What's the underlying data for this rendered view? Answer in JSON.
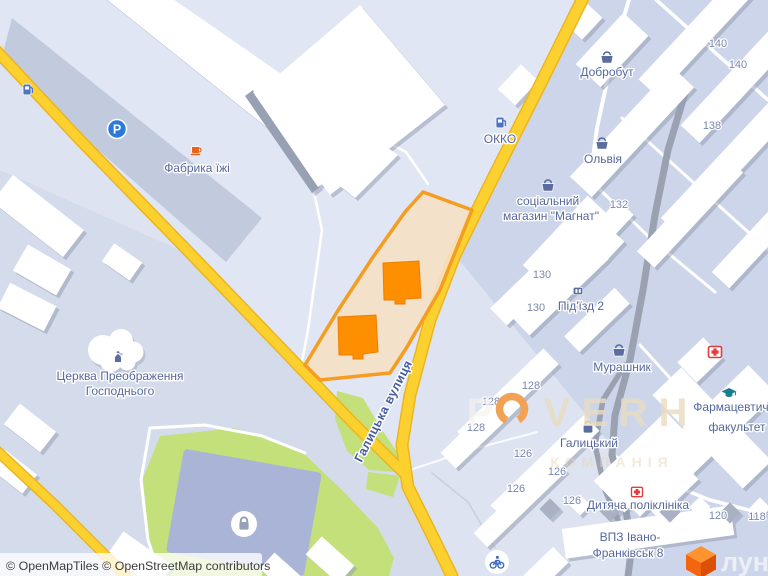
{
  "attribution": {
    "text": "© OpenMapTiles © OpenStreetMap contributors"
  },
  "street": {
    "name": "Галицька вулиця"
  },
  "pois": {
    "fabryka": "Фабрика їжі",
    "dobrobut": "Добробут",
    "okko": "ОККО",
    "olviia": "Ольвія",
    "mahnat_line1": "соціальний",
    "mahnat_line2": "магазин \"Магнат\"",
    "pidyizd": "Під'їзд 2",
    "murashnyk": "Мурашник",
    "pharm_line1": "Фармацевтичний",
    "pharm_line2": "факультет",
    "halytskyi": "Галицький",
    "polyclinic": "Дитяча поліклініка",
    "vpz_line1": "ВПЗ Івано-",
    "vpz_line2": "Франківськ 8",
    "church_line1": "Церква Преображення",
    "church_line2": "Господнього"
  },
  "house_numbers": [
    "140",
    "140",
    "138",
    "132",
    "130",
    "130",
    "128",
    "128",
    "128",
    "126",
    "126",
    "126",
    "126",
    "120",
    "118"
  ],
  "watermark": {
    "letter_p": "P",
    "letter_v": "V",
    "letter_e": "E",
    "letter_r": "R",
    "letter_h": "H",
    "subtitle": "КОМПАНІЯ",
    "logo_text": "лун"
  },
  "icons": {
    "parking_glyph": "P",
    "names": [
      "parking-icon",
      "fuel-icon",
      "cafe-cup-icon",
      "basket-icon",
      "bag-icon",
      "entrance-icon",
      "church-icon",
      "hospital-cross-icon",
      "graduation-cap-icon",
      "lock-icon",
      "bicycle-icon",
      "lun-cube-logo"
    ]
  },
  "colors": {
    "road_yellow": "#fcd12f",
    "road_casing": "#ecb51f",
    "road_gray": "#9aa2b2",
    "green": "#c3e07a",
    "water": "#a9b4d6",
    "highlight_fill": "#f6e0c4",
    "highlight_stroke": "#f59d20",
    "building_orange": "#fe8f01",
    "label_blue": "#56679c",
    "lun_orange": "#f3660f"
  }
}
